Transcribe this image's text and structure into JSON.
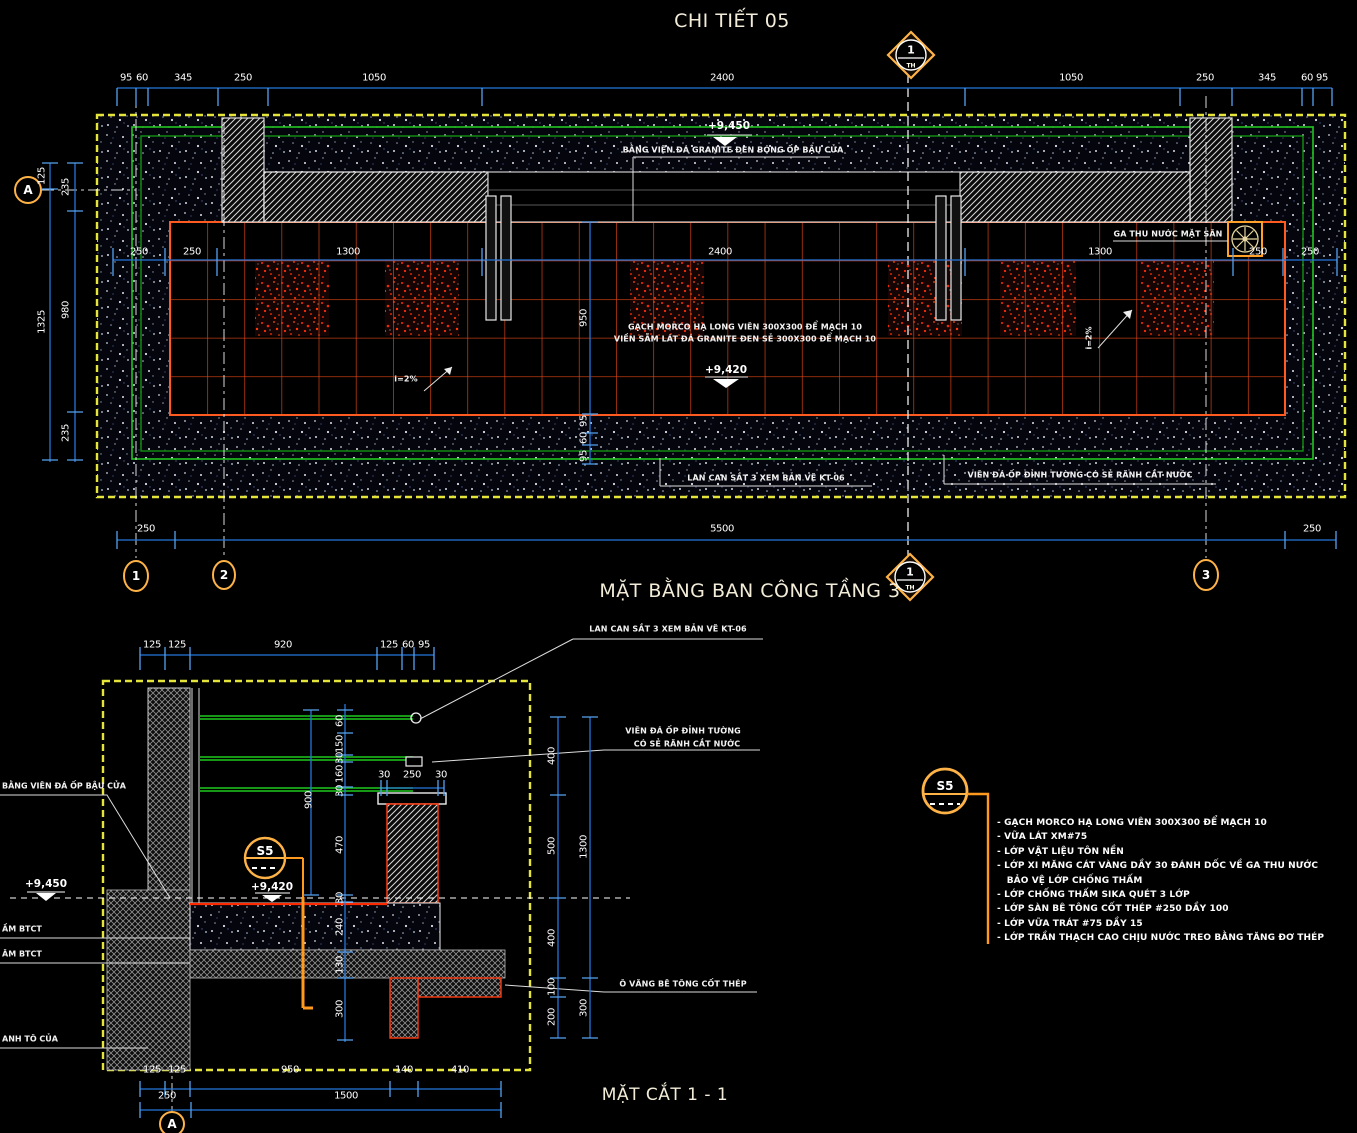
{
  "titles": {
    "detail": "CHI TIẾT 05",
    "plan": "MẶT BẰNG BAN CÔNG TẦNG 3",
    "section": "MẶT CẮT 1 - 1"
  },
  "colors": {
    "dim_blue": "#2576d9",
    "tick_blue": "#55a2f0",
    "grid_green": "#21c421",
    "tile_red": "#e34715",
    "accent_orange": "#ffa028",
    "border_yellow": "#e4e43a",
    "text_warm": "#f2ecd8"
  },
  "notes": {
    "tag": "S5",
    "items": [
      "- GẠCH MORCO HẠ LONG VIÊN 300X300 ĐỂ MẠCH 10",
      "- VỮA LÁT XM#75",
      "- LỚP VẬT LIỆU TÔN NỀN",
      "- LỚP XI MĂNG CÁT VÀNG DẦY 30 ĐÁNH DỐC VỀ GA THU NƯỚC",
      "   BẢO VỆ LỚP CHỐNG THẤM",
      "- LỚP CHỐNG THẤM SIKA QUÉT 3 LỚP",
      "- LỚP SÀN BÊ TÔNG CỐT THÉP #250 DẦY 100",
      "- LỚP VỮA TRÁT #75 DẦY 15",
      "- LỚP TRẦN THẠCH CAO CHỊU NƯỚC TREO BẰNG TĂNG ĐƠ THÉP"
    ]
  },
  "labels": [
    {
      "t": "95",
      "x": 126,
      "y": 78,
      "c": "dim"
    },
    {
      "t": "60",
      "x": 142,
      "y": 78,
      "c": "dim"
    },
    {
      "t": "345",
      "x": 183,
      "y": 78,
      "c": "dim"
    },
    {
      "t": "250",
      "x": 243,
      "y": 78,
      "c": "dim"
    },
    {
      "t": "1050",
      "x": 374,
      "y": 78,
      "c": "dim"
    },
    {
      "t": "2400",
      "x": 722,
      "y": 78,
      "c": "dim"
    },
    {
      "t": "1050",
      "x": 1071,
      "y": 78,
      "c": "dim"
    },
    {
      "t": "250",
      "x": 1205,
      "y": 78,
      "c": "dim"
    },
    {
      "t": "345",
      "x": 1267,
      "y": 78,
      "c": "dim"
    },
    {
      "t": "60",
      "x": 1307,
      "y": 78,
      "c": "dim"
    },
    {
      "t": "95",
      "x": 1322,
      "y": 78,
      "c": "dim"
    },
    {
      "t": "250",
      "x": 139,
      "y": 252,
      "c": "dim"
    },
    {
      "t": "250",
      "x": 192,
      "y": 252,
      "c": "dim"
    },
    {
      "t": "1300",
      "x": 348,
      "y": 252,
      "c": "dim"
    },
    {
      "t": "2400",
      "x": 720,
      "y": 252,
      "c": "dim"
    },
    {
      "t": "1300",
      "x": 1100,
      "y": 252,
      "c": "dim"
    },
    {
      "t": "250",
      "x": 1258,
      "y": 252,
      "c": "dim"
    },
    {
      "t": "250",
      "x": 1310,
      "y": 252,
      "c": "dim"
    },
    {
      "t": "125",
      "x": 42,
      "y": 176,
      "c": "dim-r"
    },
    {
      "t": "1325",
      "x": 42,
      "y": 322,
      "c": "dim-r"
    },
    {
      "t": "235",
      "x": 66,
      "y": 187,
      "c": "dim-r"
    },
    {
      "t": "980",
      "x": 66,
      "y": 310,
      "c": "dim-r"
    },
    {
      "t": "235",
      "x": 66,
      "y": 433,
      "c": "dim-r"
    },
    {
      "t": "950",
      "x": 584,
      "y": 318,
      "c": "dim-r"
    },
    {
      "t": "95",
      "x": 584,
      "y": 421,
      "c": "dim-r"
    },
    {
      "t": "60",
      "x": 584,
      "y": 438,
      "c": "dim-r"
    },
    {
      "t": "95",
      "x": 584,
      "y": 456,
      "c": "dim-r"
    },
    {
      "t": "250",
      "x": 146,
      "y": 529,
      "c": "dim"
    },
    {
      "t": "5500",
      "x": 722,
      "y": 529,
      "c": "dim"
    },
    {
      "t": "250",
      "x": 1312,
      "y": 529,
      "c": "dim"
    },
    {
      "t": "+9,450",
      "x": 729,
      "y": 126,
      "c": "lvl",
      "n": "level-9450-plan"
    },
    {
      "t": "BẰNG VIÊN ĐÁ GRANITE ĐEN BÓNG ỐP BẬU CỬA",
      "x": 733,
      "y": 150,
      "c": "ann",
      "n": "note-granite-sill"
    },
    {
      "t": "GA THU NƯỚC MẶT SÂN",
      "x": 1168,
      "y": 234,
      "c": "ann",
      "n": "note-floor-drain"
    },
    {
      "t": "GẠCH MORCO HẠ LONG VIÊN 300X300 ĐỂ MẠCH 10",
      "x": 745,
      "y": 327,
      "c": "ann",
      "n": "note-tile-1"
    },
    {
      "t": "VIỀN SẪM LÁT ĐÁ GRANITE ĐEN SẺ 300X300 ĐỂ MẠCH 10",
      "x": 745,
      "y": 339,
      "c": "ann",
      "n": "note-tile-2"
    },
    {
      "t": "+9,420",
      "x": 726,
      "y": 370,
      "c": "lvl",
      "n": "level-9420-plan"
    },
    {
      "t": "i=2%",
      "x": 406,
      "y": 379,
      "c": "ann",
      "n": "slope-left"
    },
    {
      "t": "i=2%",
      "x": 1089,
      "y": 338,
      "c": "ann-r",
      "n": "slope-right"
    },
    {
      "t": "LAN CAN SẮT 3 XEM BẢN VẼ KT-06",
      "x": 766,
      "y": 478,
      "c": "ann",
      "n": "note-railing-plan"
    },
    {
      "t": "VIÊN ĐÁ ỐP ĐỈNH TƯỜNG CÓ SẺ RÃNH CẮT NƯỚC",
      "x": 1080,
      "y": 475,
      "c": "ann",
      "n": "note-coping-plan"
    },
    {
      "t": "A",
      "x": 28,
      "y": 190,
      "c": "bub",
      "n": "grid-bubble-A"
    },
    {
      "t": "1",
      "x": 136,
      "y": 576,
      "c": "bub",
      "n": "grid-bubble-1"
    },
    {
      "t": "2",
      "x": 224,
      "y": 575,
      "c": "bub",
      "n": "grid-bubble-2"
    },
    {
      "t": "3",
      "x": 1206,
      "y": 575,
      "c": "bub",
      "n": "grid-bubble-3"
    },
    {
      "t": "A",
      "x": 172,
      "y": 1124,
      "c": "bub",
      "n": "grid-bubble-A-section"
    },
    {
      "t": "1",
      "x": 911,
      "y": 50,
      "c": "tag",
      "n": "section-mark-top"
    },
    {
      "t": "TH",
      "x": 911,
      "y": 66,
      "c": "tag-sub"
    },
    {
      "t": "1",
      "x": 910,
      "y": 572,
      "c": "tag",
      "n": "section-mark-bottom"
    },
    {
      "t": "TH",
      "x": 910,
      "y": 588,
      "c": "tag-sub"
    },
    {
      "t": "S5",
      "x": 945,
      "y": 786,
      "c": "s5",
      "n": "finish-tag-S5"
    },
    {
      "t": "S5",
      "x": 265,
      "y": 851,
      "c": "s5",
      "n": "finish-tag-S5-section"
    },
    {
      "t": "125",
      "x": 152,
      "y": 645,
      "c": "dim"
    },
    {
      "t": "125",
      "x": 177,
      "y": 645,
      "c": "dim"
    },
    {
      "t": "920",
      "x": 283,
      "y": 645,
      "c": "dim"
    },
    {
      "t": "125",
      "x": 389,
      "y": 645,
      "c": "dim"
    },
    {
      "t": "60",
      "x": 408,
      "y": 645,
      "c": "dim"
    },
    {
      "t": "95",
      "x": 424,
      "y": 645,
      "c": "dim"
    },
    {
      "t": "LAN CAN SẮT 3 XEM BẢN VẼ KT-06",
      "x": 668,
      "y": 629,
      "c": "ann",
      "n": "note-railing-section"
    },
    {
      "t": "VIÊN ĐÁ ỐP ĐỈNH TƯỜNG",
      "x": 683,
      "y": 731,
      "c": "ann",
      "n": "note-coping-section-1"
    },
    {
      "t": "CÓ SẺ RÃNH CẮT NƯỚC",
      "x": 687,
      "y": 744,
      "c": "ann",
      "n": "note-coping-section-2"
    },
    {
      "t": "BẰNG VIÊN ĐÁ ỐP BẬU CỬA",
      "x": 2,
      "y": 786,
      "c": "ann-l",
      "n": "note-sill-stone"
    },
    {
      "t": "+9,450",
      "x": 46,
      "y": 884,
      "c": "lvl",
      "n": "level-9450-section"
    },
    {
      "t": "ẦM BTCT",
      "x": 2,
      "y": 929,
      "c": "ann-l",
      "n": "note-beam-1"
    },
    {
      "t": "ÂM BTCT",
      "x": 2,
      "y": 954,
      "c": "ann-l",
      "n": "note-beam-2"
    },
    {
      "t": "ANH TÔ CỦA",
      "x": 2,
      "y": 1039,
      "c": "ann-l",
      "n": "note-door-frame"
    },
    {
      "t": "+9,420",
      "x": 272,
      "y": 887,
      "c": "lvl",
      "n": "level-9420-section"
    },
    {
      "t": "Ô VĂNG BÊ TÔNG CỐT THÉP",
      "x": 683,
      "y": 984,
      "c": "ann",
      "n": "note-canopy"
    },
    {
      "t": "60",
      "x": 340,
      "y": 721,
      "c": "dim-r"
    },
    {
      "t": "150",
      "x": 340,
      "y": 744,
      "c": "dim-r"
    },
    {
      "t": "30",
      "x": 340,
      "y": 758,
      "c": "dim-r"
    },
    {
      "t": "160",
      "x": 340,
      "y": 774,
      "c": "dim-r"
    },
    {
      "t": "30",
      "x": 340,
      "y": 791,
      "c": "dim-r"
    },
    {
      "t": "470",
      "x": 340,
      "y": 845,
      "c": "dim-r"
    },
    {
      "t": "30",
      "x": 340,
      "y": 898,
      "c": "dim-r"
    },
    {
      "t": "240",
      "x": 340,
      "y": 927,
      "c": "dim-r"
    },
    {
      "t": "130",
      "x": 340,
      "y": 965,
      "c": "dim-r"
    },
    {
      "t": "300",
      "x": 340,
      "y": 1009,
      "c": "dim-r"
    },
    {
      "t": "900",
      "x": 309,
      "y": 800,
      "c": "dim-r"
    },
    {
      "t": "30",
      "x": 384,
      "y": 775,
      "c": "dim"
    },
    {
      "t": "250",
      "x": 412,
      "y": 775,
      "c": "dim"
    },
    {
      "t": "30",
      "x": 441,
      "y": 775,
      "c": "dim"
    },
    {
      "t": "400",
      "x": 552,
      "y": 756,
      "c": "dim-r"
    },
    {
      "t": "500",
      "x": 552,
      "y": 846,
      "c": "dim-r"
    },
    {
      "t": "400",
      "x": 552,
      "y": 938,
      "c": "dim-r"
    },
    {
      "t": "100",
      "x": 552,
      "y": 987,
      "c": "dim-r"
    },
    {
      "t": "200",
      "x": 552,
      "y": 1017,
      "c": "dim-r"
    },
    {
      "t": "1300",
      "x": 584,
      "y": 847,
      "c": "dim-r"
    },
    {
      "t": "300",
      "x": 584,
      "y": 1008,
      "c": "dim-r"
    },
    {
      "t": "125",
      "x": 152,
      "y": 1070,
      "c": "dim"
    },
    {
      "t": "125",
      "x": 177,
      "y": 1070,
      "c": "dim"
    },
    {
      "t": "950",
      "x": 290,
      "y": 1070,
      "c": "dim"
    },
    {
      "t": "140",
      "x": 404,
      "y": 1070,
      "c": "dim"
    },
    {
      "t": "410",
      "x": 460,
      "y": 1070,
      "c": "dim"
    },
    {
      "t": "250",
      "x": 167,
      "y": 1096,
      "c": "dim"
    },
    {
      "t": "1500",
      "x": 346,
      "y": 1096,
      "c": "dim"
    }
  ]
}
